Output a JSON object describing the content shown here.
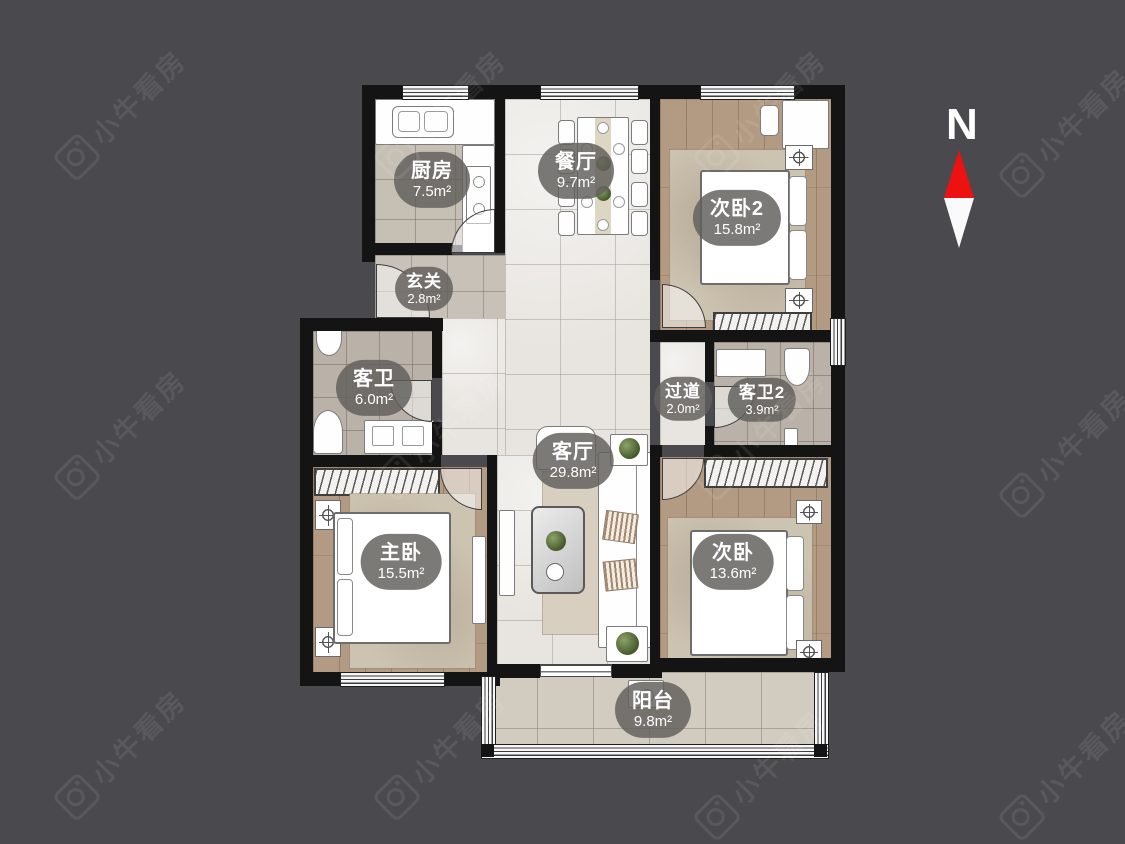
{
  "scene": {
    "type": "apartment-floor-plan"
  },
  "compass": {
    "label": "N",
    "north_color": "#ee1111",
    "south_color": "#fafafa"
  },
  "watermark": {
    "text": "小牛看房"
  },
  "palette": {
    "background": "#4a4a4e",
    "wall": "#141414",
    "label_pill": "rgba(98,95,91,0.83)",
    "marble_floor": "#e8e5e0",
    "wood_floor": "#b29b82",
    "tile_floor": "#bab2a8"
  },
  "rooms": [
    {
      "id": "kitchen",
      "name": "厨房",
      "area": "7.5m²"
    },
    {
      "id": "dining",
      "name": "餐厅",
      "area": "9.7m²"
    },
    {
      "id": "bedroom2",
      "name": "次卧2",
      "area": "15.8m²"
    },
    {
      "id": "entry",
      "name": "玄关",
      "area": "2.8m²"
    },
    {
      "id": "guest-bath",
      "name": "客卫",
      "area": "6.0m²"
    },
    {
      "id": "hallway",
      "name": "过道",
      "area": "2.0m²"
    },
    {
      "id": "guest-bath2",
      "name": "客卫2",
      "area": "3.9m²"
    },
    {
      "id": "living",
      "name": "客厅",
      "area": "29.8m²"
    },
    {
      "id": "master",
      "name": "主卧",
      "area": "15.5m²"
    },
    {
      "id": "bedroom",
      "name": "次卧",
      "area": "13.6m²"
    },
    {
      "id": "balcony",
      "name": "阳台",
      "area": "9.8m²"
    }
  ]
}
